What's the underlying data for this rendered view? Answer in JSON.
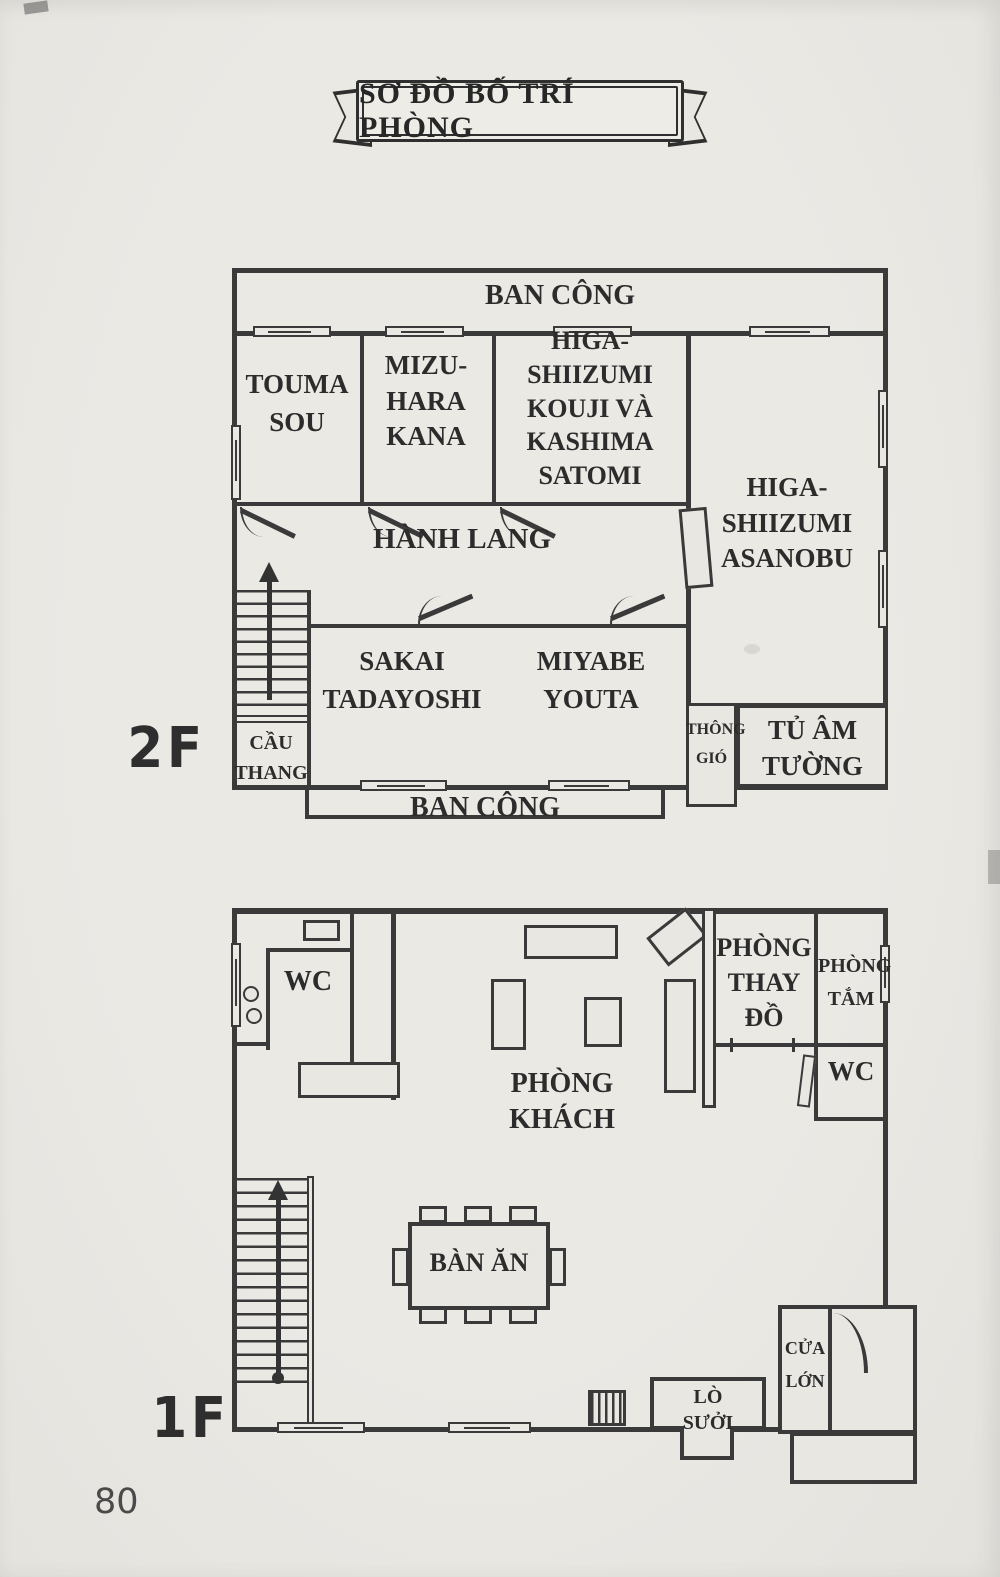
{
  "page": {
    "title": "SƠ ĐỒ BỐ TRÍ PHÒNG",
    "number": "80"
  },
  "floor2": {
    "label": "2F",
    "balcony_top": "BAN CÔNG",
    "balcony_bottom": "BAN CÔNG",
    "room_touma": "TOUMA\nSOU",
    "room_mizuhara": "MIZU-\nHARA\nKANA",
    "room_kouji_satomi": "HIGA-\nSHIIZUMI\nKOUJI VÀ\nKASHIMA\nSATOMI",
    "room_asanobu": "HIGA-\nSHIIZUMI\nASANOBU",
    "hallway": "HÀNH LANG",
    "room_sakai": "SAKAI\nTADAYOSHI",
    "room_miyabe": "MIYABE\nYOUTA",
    "stairs": "CẦU\nTHANG",
    "vent": "THÔNG\nGIÓ",
    "wall_closet": "TỦ ÂM\nTƯỜNG"
  },
  "floor1": {
    "label": "1F",
    "wc_left": "WC",
    "living_room": "PHÒNG\nKHÁCH",
    "dining_table": "BÀN ĂN",
    "changing_room": "PHÒNG\nTHAY\nĐỒ",
    "bathroom": "PHÒNG\nTẮM",
    "wc_right": "WC",
    "fireplace": "LÒ\nSƯỞI",
    "main_door": "CỬA\nLỚN"
  }
}
